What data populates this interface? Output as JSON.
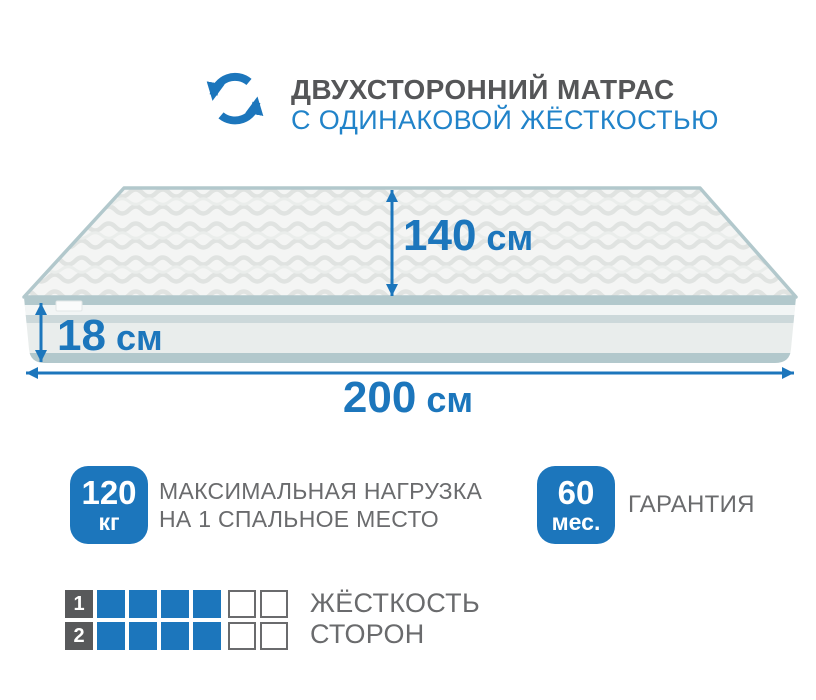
{
  "header": {
    "title": "ДВУХСТОРОННИЙ МАТРАС",
    "subtitle": "С ОДИНАКОВОЙ ЖЁСТКОСТЬЮ"
  },
  "mattress": {
    "width_label": {
      "value": "140",
      "unit": "см"
    },
    "height_label": {
      "value": "18",
      "unit": "см"
    },
    "length_label": {
      "value": "200",
      "unit": "см"
    }
  },
  "features": [
    {
      "badge_value": "120",
      "badge_unit": "кг",
      "label_line1": "МАКСИМАЛЬНАЯ НАГРУЗКА",
      "label_line2": "НА 1 СПАЛЬНОЕ МЕСТО"
    },
    {
      "badge_value": "60",
      "badge_unit": "мес.",
      "label_line1": "ГАРАНТИЯ",
      "label_line2": ""
    }
  ],
  "firmness": {
    "label_line1": "ЖЁСТКОСТЬ",
    "label_line2": "СТОРОН",
    "scale_max": 6,
    "rows": [
      {
        "side": "1",
        "value": 4
      },
      {
        "side": "2",
        "value": 4
      }
    ]
  },
  "colors": {
    "primary_blue": "#1c76bc",
    "subtitle_blue": "#2183c9",
    "title_gray": "#555658",
    "text_gray": "#6a6b6d",
    "square_dark": "#58595b",
    "piping": "#b2c8cc",
    "mattress_face": "#e9edec"
  }
}
